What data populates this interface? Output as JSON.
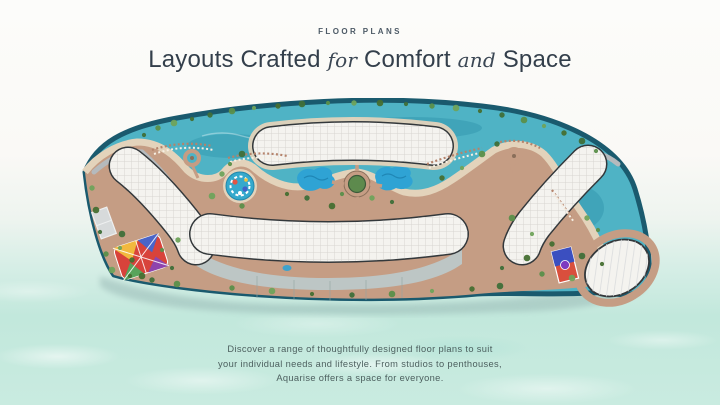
{
  "header": {
    "kicker": "FLOOR PLANS",
    "title_part1": "Layouts Crafted",
    "title_italic1": "for",
    "title_part2": "Comfort",
    "title_italic2": "and",
    "title_part3": "Space"
  },
  "description": {
    "line1": "Discover a range of thoughtfully designed floor plans to suit",
    "line2": "your individual needs and lifestyle. From studios to penthouses,",
    "line3": "Aquarise offers a space for everyone."
  },
  "masterplan": {
    "label": "aquarise-resort-masterplan-aerial-render",
    "colors": {
      "lagoon": "#4fb3c5",
      "lagoon_deep": "#2e93aa",
      "perimeter": "#1a5a6e",
      "sand_path": "#c59d84",
      "beach_sand": "#e3d3bb",
      "greenery": "#4e7d3f",
      "building": "#f4f3ef",
      "building_outline": "#33383b",
      "road": "#b5babd",
      "deck": "#bdc6c5",
      "pool": "#2fa3d4",
      "pool_deep": "#1d7b94",
      "sea_shadow": "#8fb0ad"
    }
  }
}
